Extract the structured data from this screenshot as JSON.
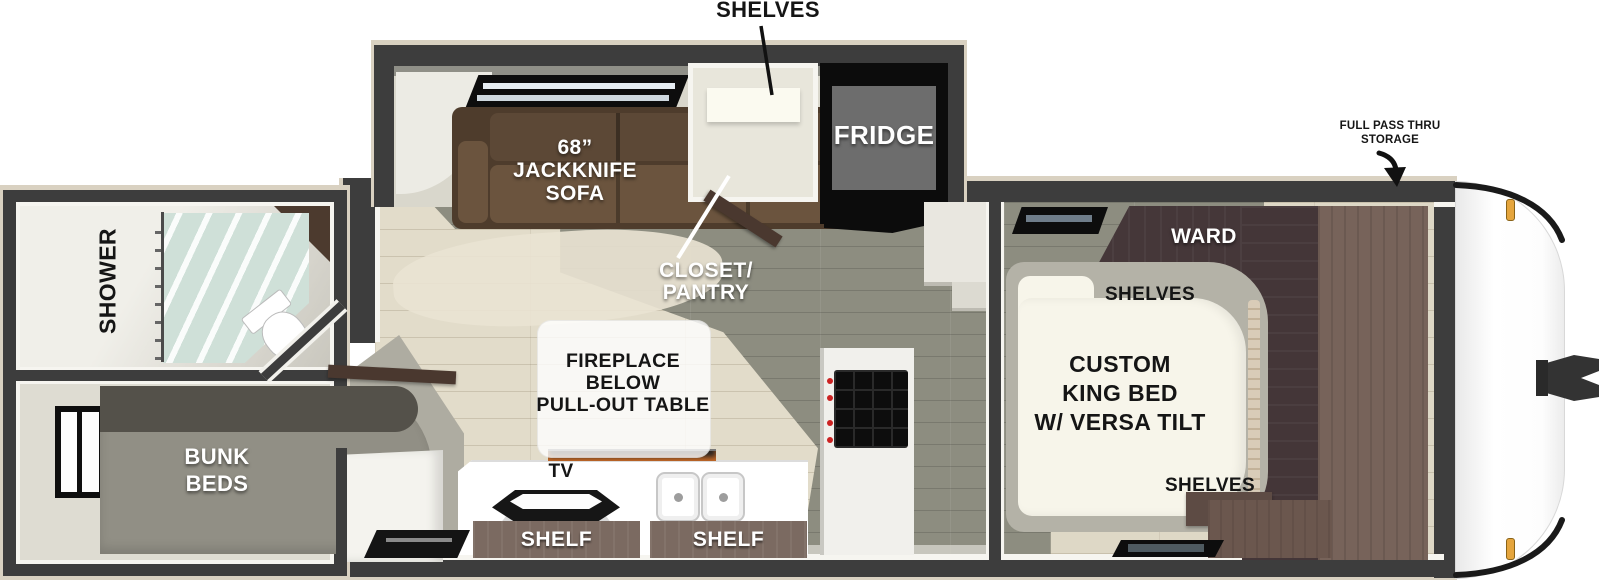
{
  "labels": {
    "slideout_shelves": "SHELVES",
    "sofa": [
      "68”",
      "JACKKNIFE",
      "SOFA"
    ],
    "closet": [
      "CLOSET/",
      "PANTRY"
    ],
    "fridge": "FRIDGE",
    "pass_thru": [
      "FULL PASS THRU",
      "STORAGE"
    ],
    "ward": "WARD",
    "bed_shelves_top": "SHELVES",
    "bed": [
      "CUSTOM",
      "KING BED",
      "W/ VERSA TILT"
    ],
    "bed_shelves_bottom": "SHELVES",
    "shower": "SHOWER",
    "bunk": [
      "BUNK",
      "BEDS"
    ],
    "fireplace": [
      "FIREPLACE",
      "BELOW",
      "PULL-OUT TABLE"
    ],
    "tv": "TV",
    "shelf_left": "SHELF",
    "shelf_right": "SHELF"
  },
  "colors": {
    "wall": "#3d3d3d",
    "wall_outline": "#d9d1c1",
    "floor_main": "#e2dcca",
    "floor_secondary": "#8d8d80",
    "sofa": "#4e3c2c",
    "counter": "#ffffff",
    "shelf_box": "#7b6a61",
    "bunk": "#918f85",
    "ward_dark": "#453739",
    "ward_light": "#77635a",
    "cap_trim": "#1a1a1a",
    "marker_light": "#e5a53d",
    "flame": "#e67828"
  }
}
